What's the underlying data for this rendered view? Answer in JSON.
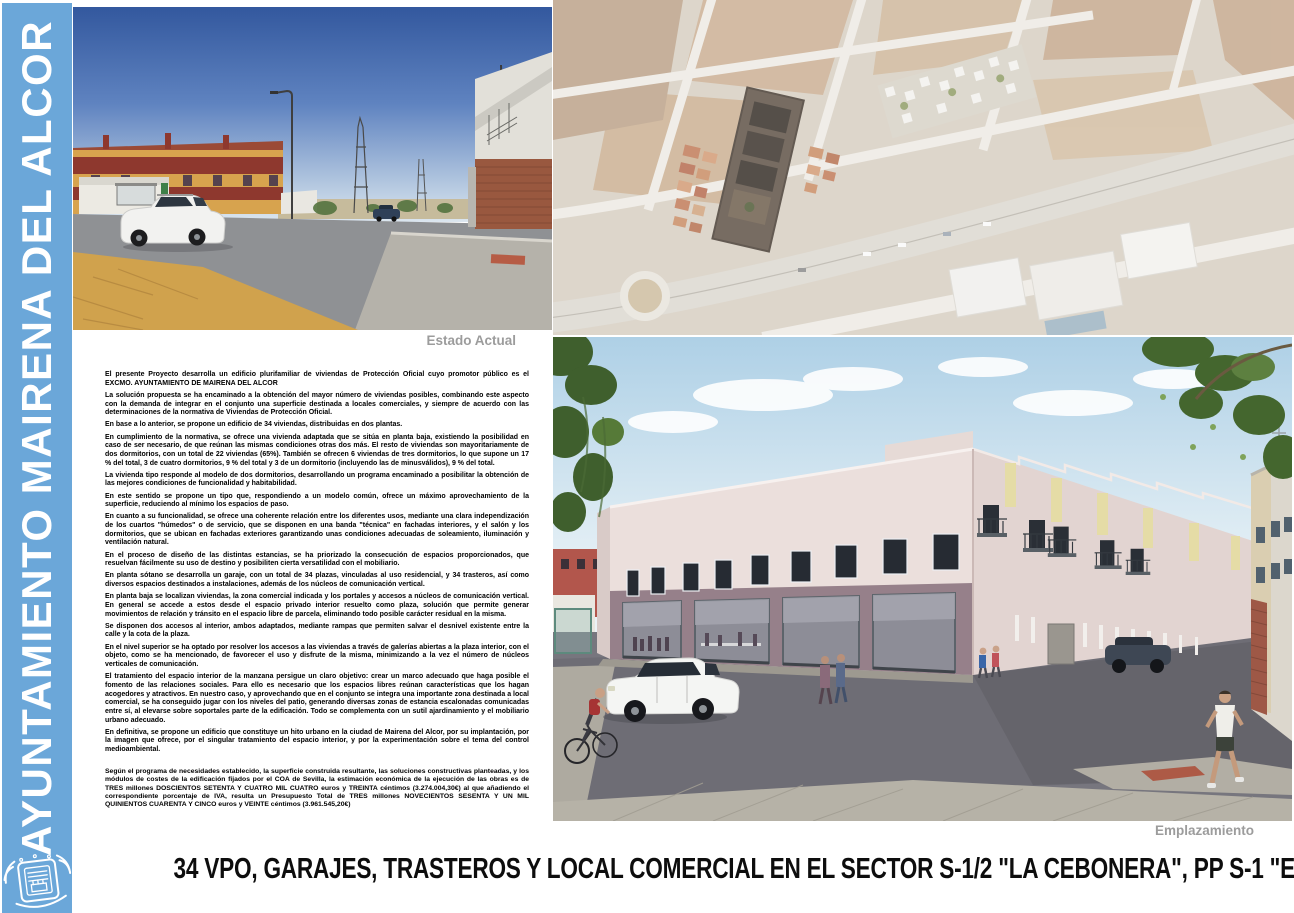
{
  "title": "34 VPO, GARAJES, TRASTEROS Y LOCAL COMERCIAL EN  EL SECTOR S-1/2 \"LA CEBONERA\", PP S-1 \"EL PATRIARCA\".",
  "sidebar": {
    "text": "AYUNTAMIENTO  MAIRENA DEL ALCOR",
    "color": "#6BA7D9",
    "logo_icon": "coat-of-arms-icon"
  },
  "captions": {
    "estado_actual": "Estado Actual",
    "emplazamiento": "Emplazamiento"
  },
  "colors": {
    "caption_gray": "#9c9c9c",
    "title_black": "#0d0d0d"
  },
  "memoria": {
    "paragraphs": [
      "El presente Proyecto desarrolla un edificio plurifamiliar de viviendas de Protección Oficial cuyo promotor público es el EXCMO. AYUNTAMIENTO DE MAIRENA DEL ALCOR",
      "La solución propuesta se ha encaminado a la obtención del mayor número de viviendas posibles, combinando este aspecto con la demanda de integrar en el conjunto una superficie destinada a locales comerciales, y siempre de acuerdo con las determinaciones de la  normativa de Viviendas de Protección Oficial.",
      "En base a lo anterior, se propone un edificio de 34 viviendas, distribuidas en dos plantas.",
      "En cumplimiento de la normativa, se ofrece  una vivienda adaptada que se sitúa  en planta baja, existiendo la posibilidad en caso de ser necesario, de que reúnan las mismas condiciones  otras dos más. El resto de viviendas son mayoritariamente de  dos dormitorios, con un total de  22 viviendas (65%). También se ofrecen  6 viviendas de tres dormitorios, lo que supone un 17 % del total, 3 de cuatro dormitorios, 9 % del total y 3 de un dormitorio (incluyendo las de minusválidos), 9 % del total.",
      "La vivienda tipo responde al modelo de  dos dormitorios, desarrollando un programa encaminado a posibilitar la obtención de las mejores condiciones de funcionalidad y habitabilidad.",
      "En este sentido se propone un tipo que, respondiendo a un modelo común, ofrece un máximo aprovechamiento de la superficie, reduciendo al mínimo los espacios de paso.",
      "En cuanto a su funcionalidad, se ofrece una coherente relación entre los diferentes usos, mediante una clara independización de los cuartos \"húmedos\" o  de servicio, que se disponen en una banda \"técnica\" en fachadas interiores, y el salón y los dormitorios, que se ubican en fachadas exteriores garantizando unas condiciones adecuadas de soleamiento, iluminación y ventilación natural.",
      "En el  proceso de diseño de las distintas estancias, se ha priorizado la consecución de espacios proporcionados, que resuelvan fácilmente su uso de destino y posibiliten cierta versatilidad con el mobiliario.",
      "En planta sótano se desarrolla un garaje, con un total de 34 plazas, vinculadas al uso residencial, y 34 trasteros, así como  diversos espacios destinados a instalaciones, además de los núcleos de comunicación vertical.",
      "En planta baja se localizan viviendas, la zona comercial indicada y los portales y accesos a núcleos de comunicación vertical. En general se accede a estos desde el espacio privado interior resuelto como plaza, solución que permite generar movimientos de relación y tránsito en el espacio libre de parcela, eliminando todo posible carácter residual en  la  misma.",
      "Se disponen dos accesos al interior, ambos adaptados,  mediante rampas  que permiten salvar el desnivel existente entre la calle y la cota de la plaza.",
      "En el nivel superior  se ha optado por resolver los accesos a las viviendas a través de galerías abiertas a la plaza interior, con el objeto, como se ha mencionado, de favorecer el uso y disfrute de la misma, minimizando a la vez el número de núcleos verticales de comunicación.",
      "El tratamiento del espacio interior de la manzana persigue un claro objetivo: crear un marco adecuado que haga posible el fomento de las relaciones sociales. Para ello es necesario que los espacios libres reúnan características que los hagan acogedores y atractivos. En nuestro caso, y aprovechando que en el conjunto se integra una importante zona destinada a local comercial, se ha conseguido jugar con los niveles del patio, generando diversas zonas de estancia escalonadas comunicadas  entre sí, al elevarse sobre soportales parte de la edificación.  Todo se complementa con un sutil ajardinamiento y el mobiliario urbano adecuado.",
      "En definitiva, se propone un edificio que constituye un hito urbano en la ciudad de  Mairena del Alcor, por su implantación, por la imagen que ofrece, por el singular tratamiento del espacio interior, y por la experimentación sobre el tema del control medioambiental.",
      "Según el programa de necesidades establecido, la superficie construida resultante, las soluciones constructivas planteadas, y los módulos de costes de la edificación fijados por el COA de Sevilla, la estimación económica de la ejecución de las obras es de TRES millones DOSCIENTOS SETENTA Y CUATRO MIL CUATRO euros y TREINTA céntimos (3.274.004,30€) al que añadiendo el correspondiente porcentaje de IVA, resulta un Presupuesto Total de TRES millones NOVECIENTOS SESENTA Y UN MIL QUINIENTOS CUARENTA Y CINCO euros y VEINTE céntimos (3.961.545,20€)"
    ]
  },
  "images": {
    "estado_actual_description": "street photo of the current empty site with apartment blocks and a parked white SUV",
    "aerial_description": "aerial view of the sector with the proposed building footprint highlighted",
    "emplazamiento_description": "3D render of the proposed two-storey housing block with commercial ground floor"
  }
}
